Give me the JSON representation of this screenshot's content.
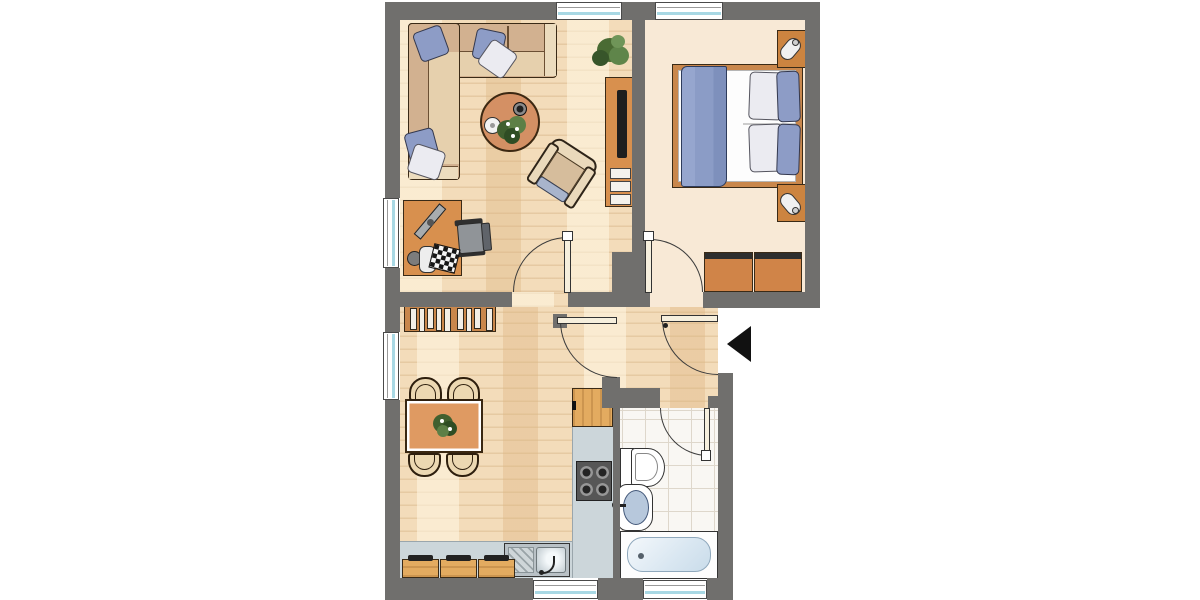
{
  "document": {
    "kind": "apartment-floor-plan",
    "visible_text": "none"
  },
  "colors": {
    "wall": "#706f6d",
    "outline": "#3a2a16",
    "outline_soft": "#3c3c3c",
    "parquet": "#f3dcba",
    "bedroom_floor": "#f8e9d6",
    "tile": "#f9f7f3",
    "tile_line": "#ded7cb",
    "counter": "#ccd6da",
    "wood": "#d8904e",
    "wood_light": "#e3ab60",
    "sofa_back": "#d2b190",
    "sofa_seat": "#e6d0ad",
    "sofa_arm": "#ecdcbe",
    "pillow_blue": "#8d9cc6",
    "blanket_blue": "#8b9cc6",
    "table_top": "#df9a62",
    "coffee_table": "#d49064",
    "stove": "#565656",
    "steel": "#b9c1c6",
    "basin_blue": "#b7c8dc",
    "window_glass": "#a8d8e4",
    "plant_green": "#4a6b33",
    "arrow_black": "#111111"
  },
  "rooms": [
    {
      "id": "living-room",
      "floor": "parquet",
      "furniture": [
        "corner-sofa",
        "sofa-pillows",
        "coffee-table",
        "teapot",
        "bowl",
        "table-plant",
        "armchair",
        "desk",
        "monitor",
        "keyboard",
        "office-chair",
        "tv-sideboard",
        "flat-tv",
        "shelf-boxes",
        "potted-plant"
      ]
    },
    {
      "id": "bedroom",
      "floor": "plain",
      "furniture": [
        "double-bed",
        "blue-blanket",
        "pillows",
        "nightstand-left",
        "nightstand-right",
        "bedside-lamp-left",
        "bedside-lamp-right",
        "dresser-left",
        "dresser-right"
      ]
    },
    {
      "id": "hallway",
      "floor": "parquet",
      "furniture": []
    },
    {
      "id": "kitchen-dining",
      "floor": "parquet",
      "furniture": [
        "bookshelf",
        "book-spines",
        "dining-table",
        "centerpiece-plant",
        "dining-chairs-4",
        "tall-cabinet",
        "kitchen-counter",
        "stove-4-burners",
        "kitchen-sink",
        "base-cabinets-3"
      ]
    },
    {
      "id": "bathroom",
      "floor": "tiles",
      "furniture": [
        "toilet",
        "washbasin",
        "bathtub"
      ]
    }
  ],
  "openings": {
    "windows": 6,
    "interior_doors": [
      "living-room-door",
      "bedroom-door",
      "kitchen-door",
      "bathroom-door"
    ],
    "entrance": {
      "marker": "black-arrow-pointing-left",
      "side": "right"
    }
  }
}
